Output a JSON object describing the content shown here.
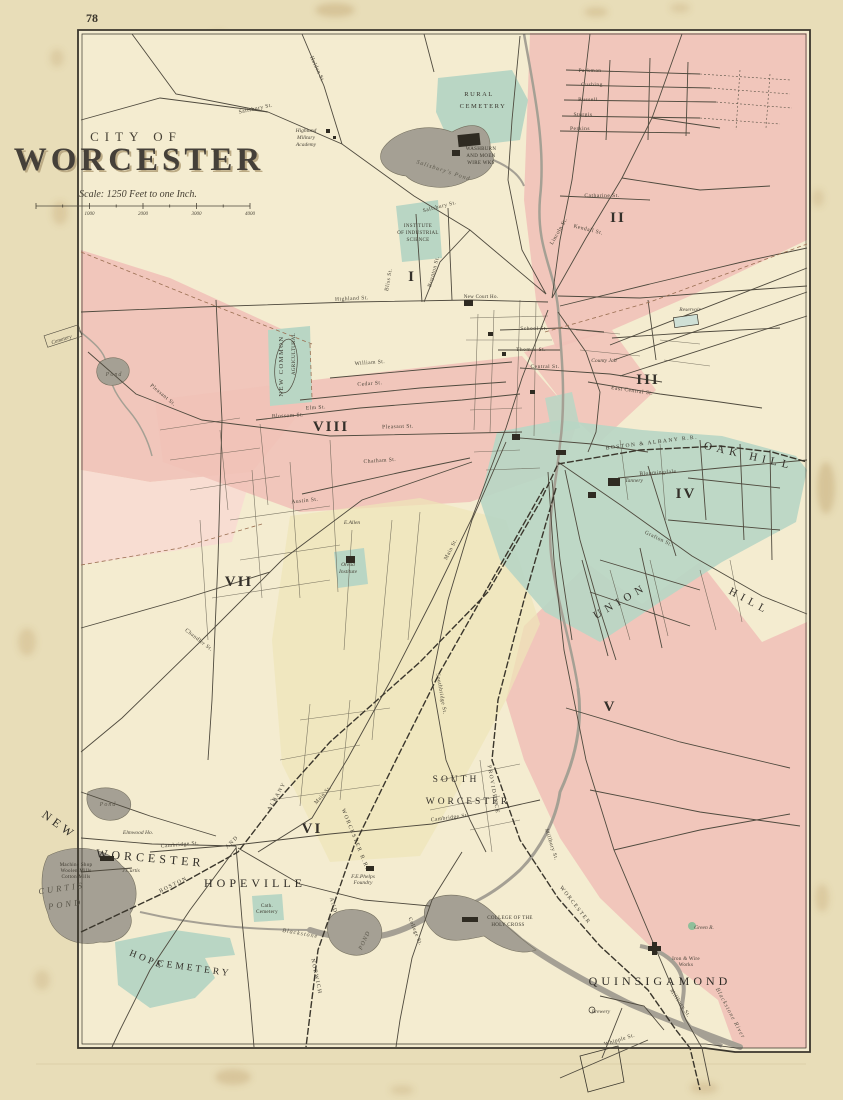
{
  "page": {
    "number": "78"
  },
  "title": {
    "kicker": "CITY OF",
    "name": "WORCESTER",
    "scale_note": "Scale: 1250 Feet to one Inch.",
    "scale_ticks": [
      "1000",
      "2000",
      "3000",
      "4000"
    ]
  },
  "colors": {
    "paper": "#e8ddb8",
    "map_cream": "#f4ecd0",
    "ward_pink": "#f1c2b8",
    "ward_pink_pale": "#f8dcd2",
    "ward_teal": "#b9d6c4",
    "ward_yellow": "#eee5b8",
    "water_gray": "#a5a094",
    "ink": "#4b463a",
    "boundary_red": "#9a6f52"
  },
  "districts": [
    "I",
    "II",
    "III",
    "IV",
    "V",
    "VI",
    "VII",
    "VIII"
  ],
  "map_labels": [
    {
      "id": "district-i",
      "text": "I",
      "x": 412,
      "y": 281,
      "cls": "district"
    },
    {
      "id": "district-ii",
      "text": "II",
      "x": 618,
      "y": 222,
      "cls": "district"
    },
    {
      "id": "district-iii",
      "text": "III",
      "x": 648,
      "y": 384,
      "cls": "district"
    },
    {
      "id": "district-iv",
      "text": "IV",
      "x": 686,
      "y": 498,
      "cls": "district"
    },
    {
      "id": "district-v",
      "text": "V",
      "x": 610,
      "y": 711,
      "cls": "district"
    },
    {
      "id": "district-vi",
      "text": "VI",
      "x": 312,
      "y": 833,
      "cls": "district"
    },
    {
      "id": "district-vii",
      "text": "VII",
      "x": 239,
      "y": 586,
      "cls": "district"
    },
    {
      "id": "district-viii",
      "text": "VIII",
      "x": 331,
      "y": 431,
      "cls": "district"
    },
    {
      "id": "rural-cemetery-1",
      "text": "RURAL",
      "x": 479,
      "y": 96,
      "cls": "place-sm"
    },
    {
      "id": "rural-cemetery-2",
      "text": "CEMETERY",
      "x": 483,
      "y": 108,
      "cls": "place-sm"
    },
    {
      "id": "washburn-works-1",
      "text": "WASHBURN",
      "x": 481,
      "y": 150,
      "cls": "tiny"
    },
    {
      "id": "washburn-works-2",
      "text": "AND MOEN",
      "x": 481,
      "y": 157,
      "cls": "tiny"
    },
    {
      "id": "washburn-works-3",
      "text": "WIRE WKS",
      "x": 481,
      "y": 164,
      "cls": "tiny"
    },
    {
      "id": "highland-academy-1",
      "text": "Highland",
      "x": 306,
      "y": 132,
      "cls": "est"
    },
    {
      "id": "highland-academy-2",
      "text": "Military",
      "x": 306,
      "y": 139,
      "cls": "est"
    },
    {
      "id": "highland-academy-3",
      "text": "Academy",
      "x": 306,
      "y": 146,
      "cls": "est"
    },
    {
      "id": "salisbury-pond",
      "text": "Salisbury's Pond",
      "x": 443,
      "y": 172,
      "cls": "water-sm",
      "rot": 18
    },
    {
      "id": "institute-1",
      "text": "INSTITUTE",
      "x": 418,
      "y": 227,
      "cls": "tiny"
    },
    {
      "id": "institute-2",
      "text": "OF INDUSTRIAL",
      "x": 418,
      "y": 234,
      "cls": "tiny"
    },
    {
      "id": "institute-3",
      "text": "SCIENCE",
      "x": 418,
      "y": 241,
      "cls": "tiny"
    },
    {
      "id": "new-common",
      "text": "NEW COMMON",
      "x": 283,
      "y": 366,
      "cls": "place-sm",
      "rot": -90
    },
    {
      "id": "agricultural-grounds",
      "text": "AGRICULTURAL",
      "x": 295,
      "y": 354,
      "cls": "tiny",
      "rot": -90
    },
    {
      "id": "cemetery-west",
      "text": "Cemetery",
      "x": 62,
      "y": 341,
      "cls": "est",
      "rot": -18
    },
    {
      "id": "pond-west",
      "text": "Pond",
      "x": 114,
      "y": 376,
      "cls": "water-sm"
    },
    {
      "id": "pond-coes",
      "text": "Pond",
      "x": 108,
      "y": 806,
      "cls": "water-sm"
    },
    {
      "id": "reservoir",
      "text": "Reservoir",
      "x": 690,
      "y": 311,
      "cls": "est"
    },
    {
      "id": "county-jail",
      "text": "County Jail",
      "x": 604,
      "y": 362,
      "cls": "est"
    },
    {
      "id": "oak-hill",
      "text": "OAK HILL",
      "x": 748,
      "y": 459,
      "cls": "hill",
      "rot": 13
    },
    {
      "id": "union-hill-1",
      "text": "UNION",
      "x": 622,
      "y": 604,
      "cls": "hill",
      "rot": -30
    },
    {
      "id": "union-hill-2",
      "text": "HILL",
      "x": 748,
      "y": 604,
      "cls": "hill",
      "rot": 28
    },
    {
      "id": "tannery",
      "text": "Tannery",
      "x": 634,
      "y": 482,
      "cls": "est"
    },
    {
      "id": "e-allen",
      "text": "E.Allen",
      "x": 352,
      "y": 524,
      "cls": "est"
    },
    {
      "id": "oread-1",
      "text": "Oread",
      "x": 348,
      "y": 566,
      "cls": "est"
    },
    {
      "id": "oread-2",
      "text": "Institute",
      "x": 348,
      "y": 573,
      "cls": "est"
    },
    {
      "id": "new-court-house",
      "text": "New Court Ho.",
      "x": 481,
      "y": 298,
      "cls": "tiny"
    },
    {
      "id": "new-worcester-1",
      "text": "NEW",
      "x": 57,
      "y": 828,
      "cls": "place-lg",
      "rot": 36
    },
    {
      "id": "new-worcester-2",
      "text": "WORCESTER",
      "x": 150,
      "y": 862,
      "cls": "place-lg",
      "rot": 5
    },
    {
      "id": "elmwood-ho",
      "text": "Elmwood Ho.",
      "x": 138,
      "y": 834,
      "cls": "est"
    },
    {
      "id": "j-curtis",
      "text": "J.Curtis",
      "x": 131,
      "y": 872,
      "cls": "est"
    },
    {
      "id": "mills-1",
      "text": "Machine Shop",
      "x": 76,
      "y": 866,
      "cls": "tiny"
    },
    {
      "id": "mills-2",
      "text": "Woolen Mills",
      "x": 76,
      "y": 872,
      "cls": "tiny"
    },
    {
      "id": "mills-3",
      "text": "Cotton Mills",
      "x": 76,
      "y": 878,
      "cls": "tiny"
    },
    {
      "id": "curtis-pond-1",
      "text": "CURTIS",
      "x": 62,
      "y": 891,
      "cls": "water",
      "rot": -8
    },
    {
      "id": "curtis-pond-2",
      "text": "POND",
      "x": 66,
      "y": 907,
      "cls": "water",
      "rot": -8
    },
    {
      "id": "hopeville",
      "text": "HOPEVILLE",
      "x": 255,
      "y": 887,
      "cls": "place-lg"
    },
    {
      "id": "hope-cemetery-1",
      "text": "HOPE",
      "x": 146,
      "y": 962,
      "cls": "place-md",
      "rot": 22
    },
    {
      "id": "hope-cemetery-2",
      "text": "CEMETERY",
      "x": 194,
      "y": 971,
      "cls": "place-md",
      "rot": 8
    },
    {
      "id": "cath-cemetery-1",
      "text": "Cath.",
      "x": 267,
      "y": 907,
      "cls": "tiny"
    },
    {
      "id": "cath-cemetery-2",
      "text": "Cemetery",
      "x": 267,
      "y": 913,
      "cls": "tiny"
    },
    {
      "id": "pond-hopeville",
      "text": "POND",
      "x": 366,
      "y": 941,
      "cls": "water-sm",
      "rot": -65
    },
    {
      "id": "blackstone",
      "text": "Blackstone",
      "x": 300,
      "y": 935,
      "cls": "water-sm",
      "rot": 10
    },
    {
      "id": "south-worcester-1",
      "text": "SOUTH",
      "x": 456,
      "y": 782,
      "cls": "place-md"
    },
    {
      "id": "south-worcester-2",
      "text": "WORCESTER",
      "x": 468,
      "y": 804,
      "cls": "place-md"
    },
    {
      "id": "holy-cross-1",
      "text": "COLLEGE OF THE",
      "x": 510,
      "y": 919,
      "cls": "tiny"
    },
    {
      "id": "holy-cross-2",
      "text": "HOLY CROSS",
      "x": 508,
      "y": 926,
      "cls": "tiny"
    },
    {
      "id": "phelps-1",
      "text": "F.E.Phelps",
      "x": 363,
      "y": 878,
      "cls": "est"
    },
    {
      "id": "phelps-2",
      "text": "Foundry",
      "x": 363,
      "y": 884,
      "cls": "est"
    },
    {
      "id": "quinsigamond",
      "text": "QUINSIGAMOND",
      "x": 660,
      "y": 985,
      "cls": "place-lg"
    },
    {
      "id": "wire-works-1",
      "text": "Iron & Wire",
      "x": 686,
      "y": 960,
      "cls": "tiny"
    },
    {
      "id": "wire-works-2",
      "text": "Works",
      "x": 686,
      "y": 966,
      "cls": "tiny"
    },
    {
      "id": "green-r",
      "text": "Green R.",
      "x": 704,
      "y": 929,
      "cls": "est"
    },
    {
      "id": "brewery",
      "text": "Brewery",
      "x": 601,
      "y": 1013,
      "cls": "est"
    },
    {
      "id": "blackstone-river",
      "text": "Blackstone River",
      "x": 729,
      "y": 1014,
      "cls": "water-sm",
      "rot": 62
    },
    {
      "id": "salisbury-st-1",
      "text": "Salisbury St.",
      "x": 256,
      "y": 110,
      "cls": "street",
      "rot": -12
    },
    {
      "id": "salisbury-st-2",
      "text": "Salisbury St.",
      "x": 440,
      "y": 208,
      "cls": "street",
      "rot": -14
    },
    {
      "id": "holden-st",
      "text": "Holden St.",
      "x": 316,
      "y": 70,
      "cls": "street",
      "rot": 65
    },
    {
      "id": "lincoln-st",
      "text": "Lincoln St.",
      "x": 560,
      "y": 232,
      "cls": "street",
      "rot": -60
    },
    {
      "id": "kendall-st",
      "text": "Kendall St.",
      "x": 588,
      "y": 231,
      "cls": "street",
      "rot": 14
    },
    {
      "id": "catharine-st",
      "text": "Catharine St.",
      "x": 602,
      "y": 197,
      "cls": "street"
    },
    {
      "id": "parkman-st",
      "text": "Parkman",
      "x": 590,
      "y": 72,
      "cls": "street"
    },
    {
      "id": "cushing-st",
      "text": "Cushing",
      "x": 592,
      "y": 86,
      "cls": "street"
    },
    {
      "id": "russell-st",
      "text": "Russell",
      "x": 588,
      "y": 101,
      "cls": "street"
    },
    {
      "id": "sturgis-st",
      "text": "Sturgis",
      "x": 583,
      "y": 116,
      "cls": "street"
    },
    {
      "id": "perkins-st",
      "text": "Perkins",
      "x": 580,
      "y": 130,
      "cls": "street"
    },
    {
      "id": "highland-st",
      "text": "Highland St.",
      "x": 352,
      "y": 300,
      "cls": "street",
      "rot": -3
    },
    {
      "id": "bliss-st",
      "text": "Bliss St.",
      "x": 390,
      "y": 280,
      "cls": "street",
      "rot": -80
    },
    {
      "id": "boynton-st",
      "text": "Boynton St.",
      "x": 435,
      "y": 272,
      "cls": "street",
      "rot": -75
    },
    {
      "id": "school-st",
      "text": "School St.",
      "x": 534,
      "y": 330,
      "cls": "street"
    },
    {
      "id": "thomas-st",
      "text": "Thomas St.",
      "x": 531,
      "y": 351,
      "cls": "street"
    },
    {
      "id": "central-st",
      "text": "Central St.",
      "x": 545,
      "y": 368,
      "cls": "street"
    },
    {
      "id": "east-central-st",
      "text": "East Central St.",
      "x": 632,
      "y": 392,
      "cls": "street",
      "rot": 8
    },
    {
      "id": "william-st",
      "text": "William St.",
      "x": 370,
      "y": 364,
      "cls": "street",
      "rot": -4
    },
    {
      "id": "cedar-st",
      "text": "Cedar St.",
      "x": 370,
      "y": 385,
      "cls": "street",
      "rot": -4
    },
    {
      "id": "elm-st",
      "text": "Elm St.",
      "x": 316,
      "y": 409,
      "cls": "street",
      "rot": -4
    },
    {
      "id": "blossom-st",
      "text": "Blossom St.",
      "x": 288,
      "y": 417,
      "cls": "street",
      "rot": -3
    },
    {
      "id": "pleasant-st-1",
      "text": "Pleasant St.",
      "x": 162,
      "y": 396,
      "cls": "street",
      "rot": 40
    },
    {
      "id": "pleasant-st-2",
      "text": "Pleasant St.",
      "x": 398,
      "y": 428,
      "cls": "street",
      "rot": -2
    },
    {
      "id": "chatham-st",
      "text": "Chatham St.",
      "x": 380,
      "y": 462,
      "cls": "street",
      "rot": -4
    },
    {
      "id": "austin-st",
      "text": "Austin St.",
      "x": 305,
      "y": 502,
      "cls": "street",
      "rot": -6
    },
    {
      "id": "chandler-st",
      "text": "Chandler St.",
      "x": 198,
      "y": 641,
      "cls": "street",
      "rot": 38
    },
    {
      "id": "main-st-1",
      "text": "Main St.",
      "x": 452,
      "y": 550,
      "cls": "street",
      "rot": -63
    },
    {
      "id": "main-st-2",
      "text": "Main St.",
      "x": 324,
      "y": 796,
      "cls": "street",
      "rot": -48
    },
    {
      "id": "grafton-st",
      "text": "Grafton St.",
      "x": 658,
      "y": 540,
      "cls": "street",
      "rot": 26
    },
    {
      "id": "bloomingdale-rd",
      "text": "Bloomingdale",
      "x": 658,
      "y": 474,
      "cls": "street",
      "rot": -4
    },
    {
      "id": "millbury-st-1",
      "text": "Millbury St.",
      "x": 550,
      "y": 845,
      "cls": "street",
      "rot": 72
    },
    {
      "id": "millbury-st-2",
      "text": "Millbury St.",
      "x": 679,
      "y": 1004,
      "cls": "street",
      "rot": 56
    },
    {
      "id": "whipple-st",
      "text": "Whipple St.",
      "x": 620,
      "y": 1041,
      "cls": "street",
      "rot": -17
    },
    {
      "id": "southbridge-st",
      "text": "Southbridge St.",
      "x": 440,
      "y": 694,
      "cls": "street",
      "rot": 80
    },
    {
      "id": "cambridge-st-1",
      "text": "Cambridge St.",
      "x": 180,
      "y": 846,
      "cls": "street",
      "rot": -5
    },
    {
      "id": "cambridge-st-2",
      "text": "Cambridge St.",
      "x": 450,
      "y": 819,
      "cls": "street",
      "rot": -7
    },
    {
      "id": "college-st",
      "text": "College St.",
      "x": 414,
      "y": 932,
      "cls": "street",
      "rot": 68
    },
    {
      "id": "ba-rr-1",
      "text": "BOSTON & ALBANY R.R.",
      "x": 652,
      "y": 444,
      "cls": "rr",
      "rot": -7
    },
    {
      "id": "ba-rr-2",
      "text": "BOSTON",
      "x": 174,
      "y": 886,
      "cls": "rr",
      "rot": -26
    },
    {
      "id": "ba-rr-3",
      "text": "AND",
      "x": 233,
      "y": 843,
      "cls": "rr",
      "rot": -45
    },
    {
      "id": "ba-rr-4",
      "text": "ALBANY",
      "x": 278,
      "y": 797,
      "cls": "rr",
      "rot": -60
    },
    {
      "id": "nw-rr-1",
      "text": "NORWICH",
      "x": 315,
      "y": 977,
      "cls": "rr",
      "rot": 78
    },
    {
      "id": "nw-rr-2",
      "text": "AND",
      "x": 332,
      "y": 906,
      "cls": "rr",
      "rot": 74
    },
    {
      "id": "nw-rr-3",
      "text": "WORCESTER R.R.",
      "x": 354,
      "y": 840,
      "cls": "rr",
      "rot": 68
    },
    {
      "id": "pw-rr-1",
      "text": "PROVIDENCE",
      "x": 492,
      "y": 790,
      "cls": "rr",
      "rot": 80
    },
    {
      "id": "pw-rr-2",
      "text": "WORCESTER",
      "x": 574,
      "y": 906,
      "cls": "rr",
      "rot": 52
    }
  ]
}
